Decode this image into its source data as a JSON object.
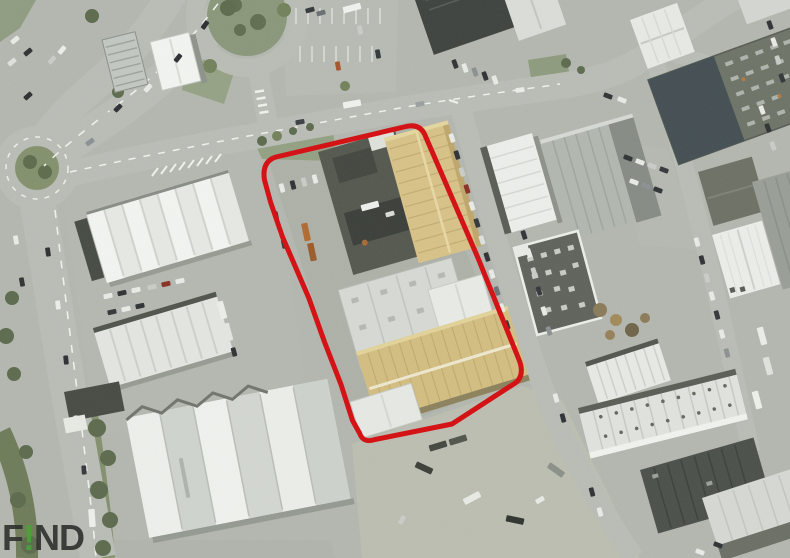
{
  "watermark": {
    "text": "F!ND",
    "prefix": "F",
    "accent": "!",
    "suffix": "ND",
    "accent_color": "#4aa238",
    "text_color": "#30332f"
  },
  "boundary": {
    "color": "#d41317",
    "stroke_width": 5,
    "path": "M 276 157 L 406 126.5 Q 421 123 426 137.5 L 478 258 L 519.5 361 Q 524.5 375 516 382.5 L 452 424 L 375 439.5 Q 363 443.5 359.5 433 L 352.5 420.5 L 341 384.5 L 324.5 342 L 309 298.5 L 295.5 267 L 282.5 237 L 270.5 202 L 264.5 180 Q 261.5 161.5 276 157 Z"
  },
  "palette": {
    "yellow_roof_1": "#d8c287",
    "yellow_roof_2": "#d3be80",
    "grass": "#93a082",
    "road": "#b9bdb6",
    "pavement": "#b3b7af"
  }
}
